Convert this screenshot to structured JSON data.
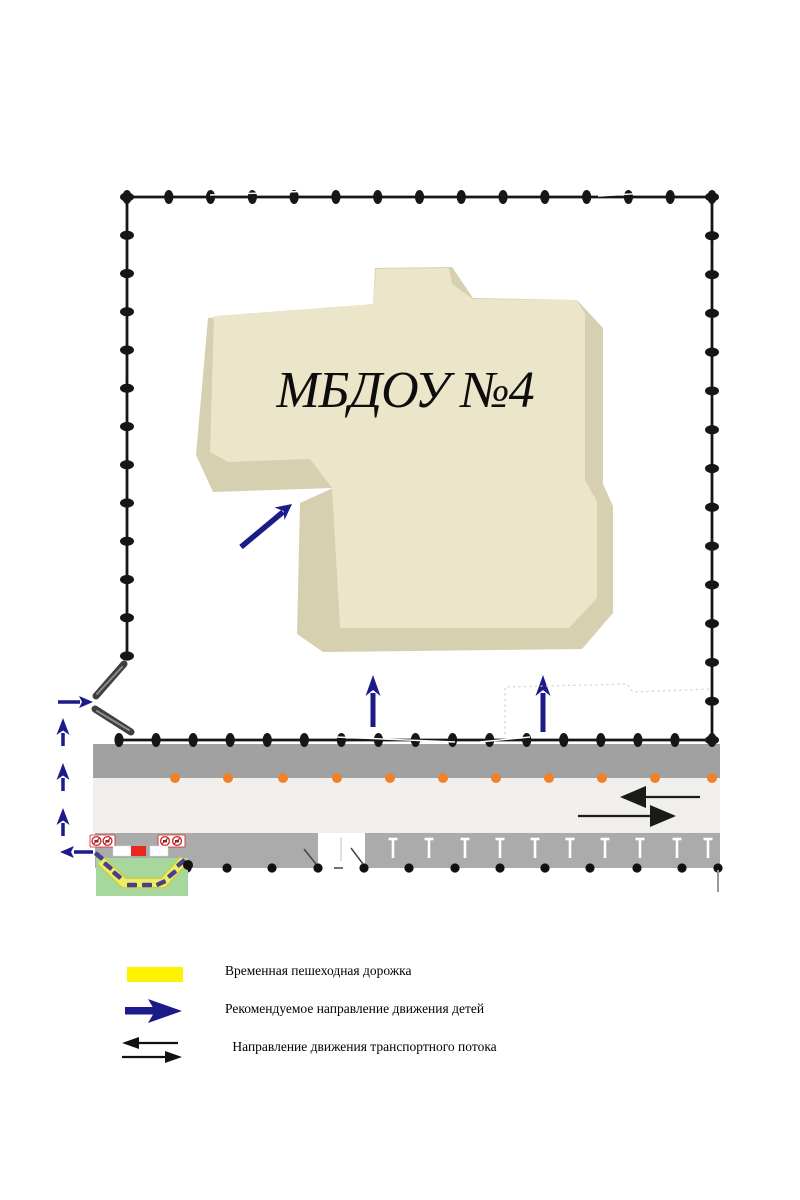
{
  "building": {
    "label": "МБДОУ №4"
  },
  "legend": {
    "items": [
      {
        "name": "temporary-pedestrian-walkway",
        "label": "Временная пешеходная дорожка"
      },
      {
        "name": "children-movement-direction",
        "label": "Рекомендуемое направление движения детей"
      },
      {
        "name": "traffic-flow-direction",
        "label": " Направление движения транспортного потока"
      }
    ]
  },
  "icons": {
    "walkway-swatch": "yellow-rectangle",
    "children-route-arrow": "thick-navy-right-arrow",
    "traffic-flow-arrows": "black-left-and-right-arrows",
    "no-entry-sign": "red-circle-prohibition-pair",
    "fence-post": "black-oval-dot",
    "gate": "two-gray-diagonal-bars"
  },
  "colors": {
    "building_top": "#ebe5c9",
    "building_side": "#d6d0b1",
    "fence": "#161616",
    "sidewalk": "#a1a1a1",
    "roadway": "#f0efec",
    "parking": "#ababab",
    "orange_marker": "#f08129",
    "route_blue": "#1b1b8a",
    "walkway_yellow": "#fff200",
    "lawn_green": "#a6d89e",
    "path_yellow": "#edee62",
    "walkway_dash_purple": "#4a3f8f",
    "sign_red": "#cc2222",
    "arrow_black": "#111111"
  }
}
